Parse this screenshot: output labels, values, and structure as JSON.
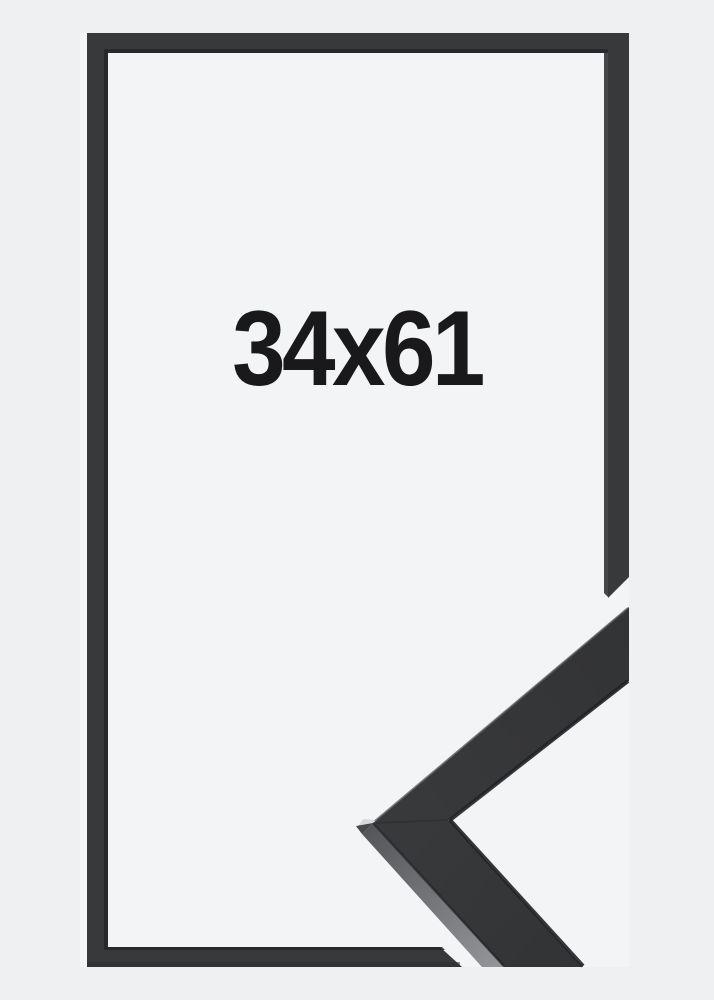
{
  "product": {
    "size_label": "34x61",
    "description": "empty picture frame, thin dark moulding, with magnified corner profile detail"
  },
  "colors": {
    "page_bg": "#eff0f1",
    "inner_bg": "#f3f4f5",
    "frame": "#38393b",
    "frame_inner_edge": "#26272a",
    "detail_edge_shadow": "#232428",
    "detail_side_dark": "#55565a",
    "detail_side_light": "#949598",
    "detail_top_highlight": "#55565a",
    "apex_highlight": "#d7d8da",
    "apex_facet": "#47484b",
    "label": "#19191b"
  }
}
